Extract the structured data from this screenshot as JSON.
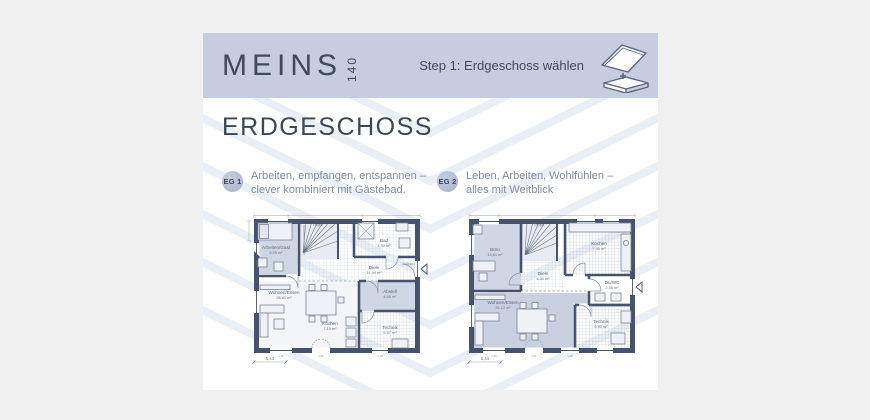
{
  "header": {
    "brand": "MEINS",
    "brand_number": "140",
    "step_label": "Step 1: Erdgeschoss wählen",
    "icon": "house-floor-select-icon"
  },
  "page_title": "ERDGESCHOSS",
  "options": [
    {
      "badge": "EG 1",
      "description": [
        "Arbeiten, empfangen, entspannen –",
        "clever kombiniert mit Gästebad."
      ]
    },
    {
      "badge": "EG 2",
      "description": [
        "Leben, Arbeiten, Wohlfühlen –",
        "alles mit Weitblick"
      ]
    }
  ],
  "plans": [
    {
      "id": "EG 1",
      "rooms": {
        "arbeiten": {
          "label": "Arbeiten/Gast",
          "area": "9,59 m²"
        },
        "treppe": {
          "label": "Treppe"
        },
        "bad": {
          "label": "Bad",
          "area": "4,92 m²"
        },
        "diele": {
          "label": "Diele",
          "area": "11,44 m²"
        },
        "wohnen": {
          "label": "Wohnen/Essen",
          "area": "28,61 m²"
        },
        "kochen": {
          "label": "Kochen",
          "area": "7,19 m²"
        },
        "abstell": {
          "label": "Abstell",
          "area": "4,05 m²"
        },
        "technik": {
          "label": "Technik",
          "area": "5,57 m²"
        }
      },
      "dimensions": {
        "bottom": "5,43",
        "window_dims": [
          "1,26",
          "2,01",
          "1,26"
        ]
      }
    },
    {
      "id": "EG 2",
      "rooms": {
        "buero": {
          "label": "Büro",
          "area": "14,61 m²"
        },
        "treppe": {
          "label": "Treppe"
        },
        "kochen": {
          "label": "Kochen",
          "area": "7,44 m²"
        },
        "diele": {
          "label": "Diele",
          "area": "4,30 m²"
        },
        "duwc": {
          "label": "Du/WC",
          "area": "2,56 m²"
        },
        "wohnen": {
          "label": "Wohnen/Essen",
          "area": "34,12 m²"
        },
        "technik": {
          "label": "Technik",
          "area": "6,90 m²"
        }
      },
      "dimensions": {
        "bottom": "5,44",
        "window_dims": [
          "1,26",
          "2,01",
          "1,26"
        ]
      }
    }
  ],
  "colors": {
    "page_background": "#f0f0f0",
    "header_band": "#c5cdde",
    "accent_dark": "#46536b",
    "room_shade": "#cfd6e4",
    "wohnen_shade": "#c9d1e0",
    "chevron": "#eaeef5",
    "text_dark": "#3c4754",
    "text_muted": "#838d9b"
  }
}
